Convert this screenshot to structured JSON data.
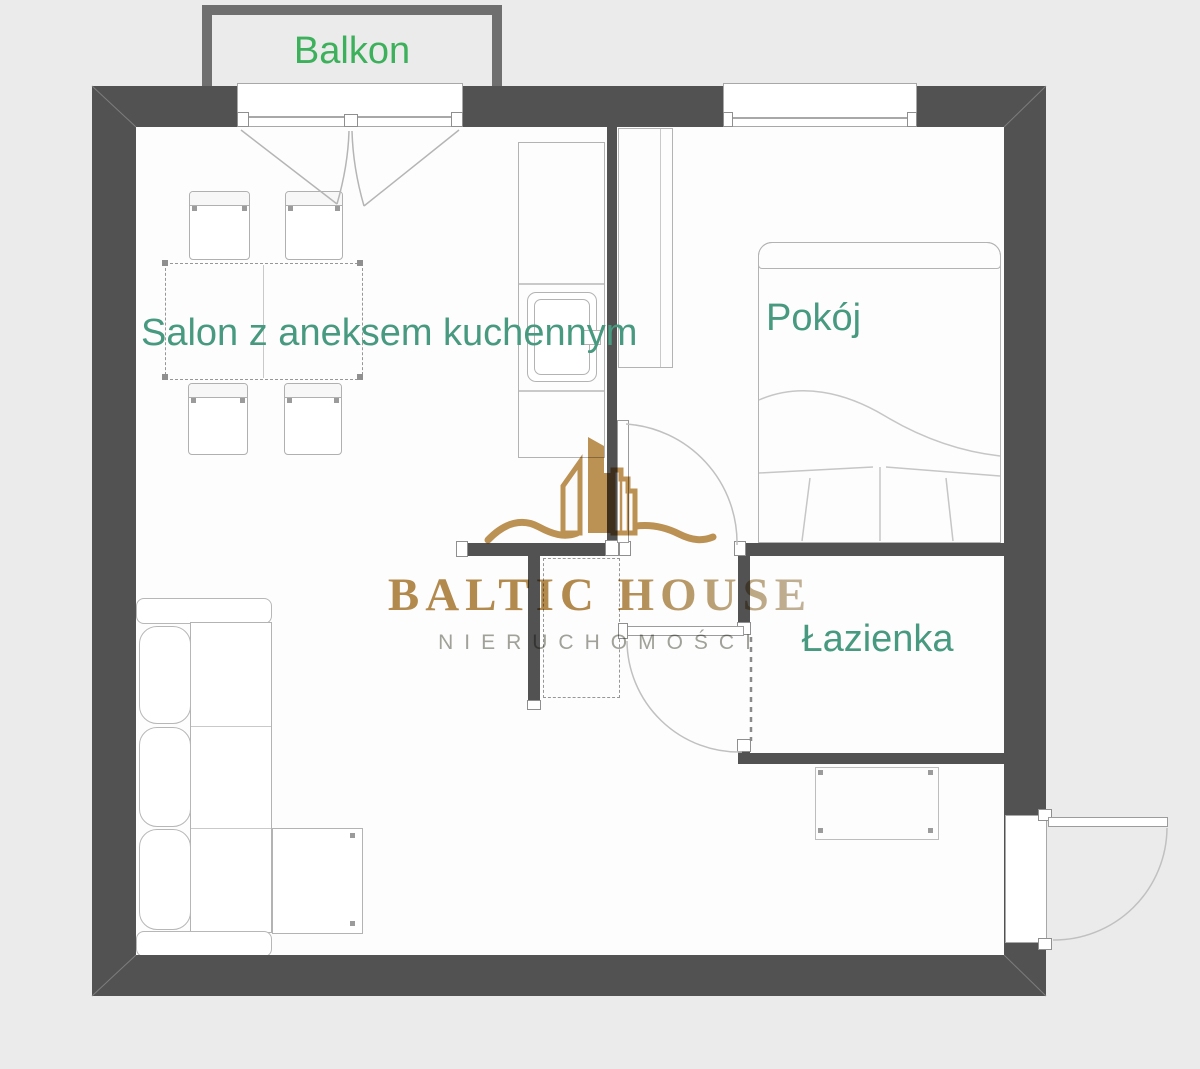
{
  "plan": {
    "type": "apartment-floor-plan",
    "rooms": {
      "balcony": "Balkon",
      "living": "Salon z aneksem kuchennym",
      "bedroom": "Pokój",
      "bathroom": "Łazienka"
    },
    "furniture": [
      "dining-table",
      "chairs",
      "corner-sofa",
      "kitchen-counter",
      "sink",
      "wardrobe",
      "double-bed",
      "hall-cabinet",
      "entry-cabinet"
    ],
    "colors": {
      "wall": "#525252",
      "balcony_wall": "#6f6f6f",
      "background": "#ebebeb",
      "floor": "#fdfdfd",
      "room_label_green": "#47997f",
      "balcony_label_green": "#3cb05a",
      "furniture_line": "#b3b3b3",
      "logo_gold": "#bd9254",
      "logo_gray": "#a2a29a"
    }
  },
  "logo": {
    "brand_1": "BALTIC",
    "brand_2": "HOUSE",
    "subtitle": "NIERUCHOMOŚCI"
  }
}
